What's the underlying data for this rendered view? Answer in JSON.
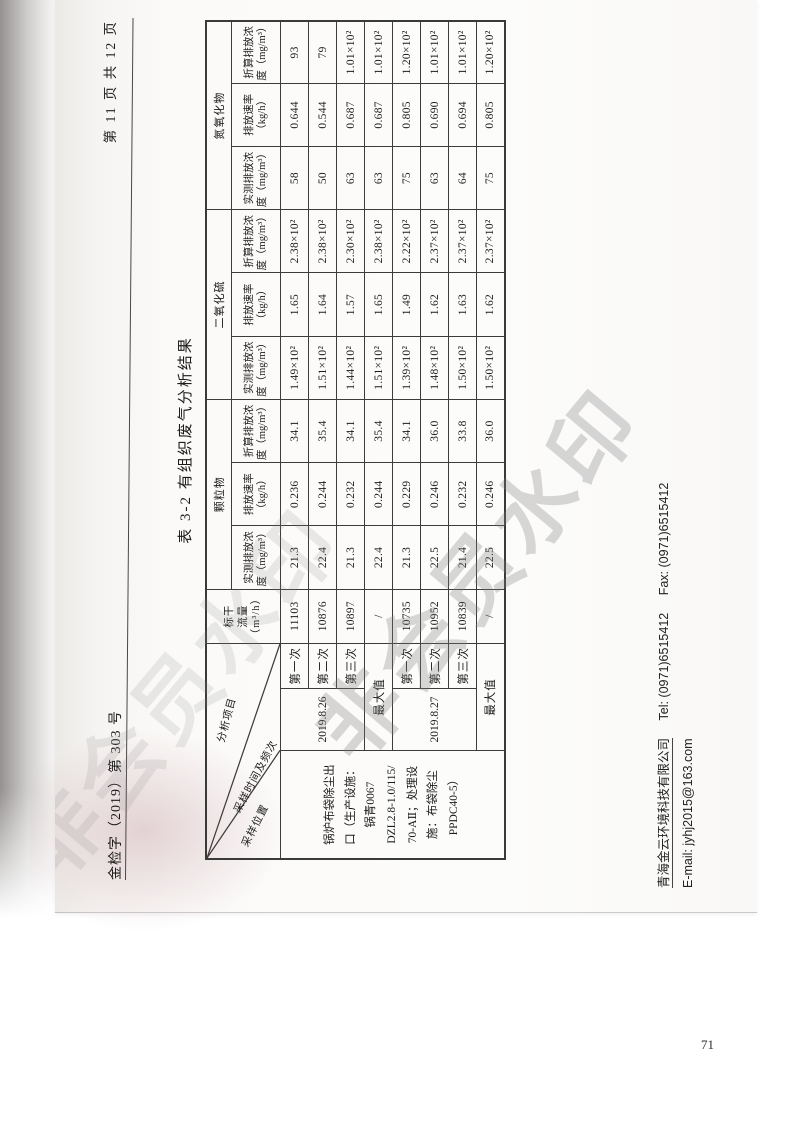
{
  "watermark": {
    "text": "非会员水印"
  },
  "header": {
    "doc_number": "金检字（2019）第 303 号",
    "page_indicator": "第 11 页 共 12 页"
  },
  "table": {
    "title": "表 3-2  有组织废气分析结果",
    "corner": {
      "analysis": "分析项目",
      "time": "采样时间及频次",
      "location": "采样位置"
    },
    "flow_header": "标干\n流量\n（m³/h）",
    "groups": [
      "颗粒物",
      "二氧化硫",
      "氮氧化物"
    ],
    "sub_headers": [
      "实测排放浓度（mg/m³）",
      "排放速率（kg/h）",
      "折算排放浓度（mg/m³）"
    ],
    "location": "锅炉布袋除尘出\n口（生产设施：\n锅青0067\nDZL2.8-1.0/115/\n70-AⅡ；处理设\n施：布袋除尘\nPPDC40-5）",
    "rows": [
      {
        "date": "2019.8.26",
        "date_rowspan": 3,
        "seq": "第一次",
        "flow": "11103",
        "values": [
          "21.3",
          "0.236",
          "34.1",
          "1.49×10²",
          "1.65",
          "2.38×10²",
          "58",
          "0.644",
          "93"
        ]
      },
      {
        "seq": "第二次",
        "flow": "10876",
        "values": [
          "22.4",
          "0.244",
          "35.4",
          "1.51×10²",
          "1.64",
          "2.38×10²",
          "50",
          "0.544",
          "79"
        ]
      },
      {
        "seq": "第三次",
        "flow": "10897",
        "values": [
          "21.3",
          "0.232",
          "34.1",
          "1.44×10²",
          "1.57",
          "2.30×10²",
          "63",
          "0.687",
          "1.01×10²"
        ]
      },
      {
        "seq": "最大值",
        "seq_colspan": 2,
        "flow": "/",
        "values": [
          "22.4",
          "0.244",
          "35.4",
          "1.51×10²",
          "1.65",
          "2.38×10²",
          "63",
          "0.687",
          "1.01×10²"
        ]
      },
      {
        "date": "2019.8.27",
        "date_rowspan": 3,
        "seq": "第一次",
        "flow": "10735",
        "values": [
          "21.3",
          "0.229",
          "34.1",
          "1.39×10²",
          "1.49",
          "2.22×10²",
          "75",
          "0.805",
          "1.20×10²"
        ]
      },
      {
        "seq": "第二次",
        "flow": "10952",
        "values": [
          "22.5",
          "0.246",
          "36.0",
          "1.48×10²",
          "1.62",
          "2.37×10²",
          "63",
          "0.690",
          "1.01×10²"
        ]
      },
      {
        "seq": "第三次",
        "flow": "10839",
        "values": [
          "21.4",
          "0.232",
          "33.8",
          "1.50×10²",
          "1.63",
          "2.37×10²",
          "64",
          "0.694",
          "1.01×10²"
        ]
      },
      {
        "seq": "最大值",
        "seq_colspan": 2,
        "flow": "/",
        "values": [
          "22.5",
          "0.246",
          "36.0",
          "1.50×10²",
          "1.62",
          "2.37×10²",
          "75",
          "0.805",
          "1.20×10²"
        ]
      }
    ]
  },
  "footer": {
    "company": "青海金云环境科技有限公司",
    "tel": "Tel:  (0971)6515412",
    "fax": "Fax:  (0971)6515412",
    "email": "E-mail:  jyhj2015@163.com"
  },
  "outer_page_number": "71"
}
